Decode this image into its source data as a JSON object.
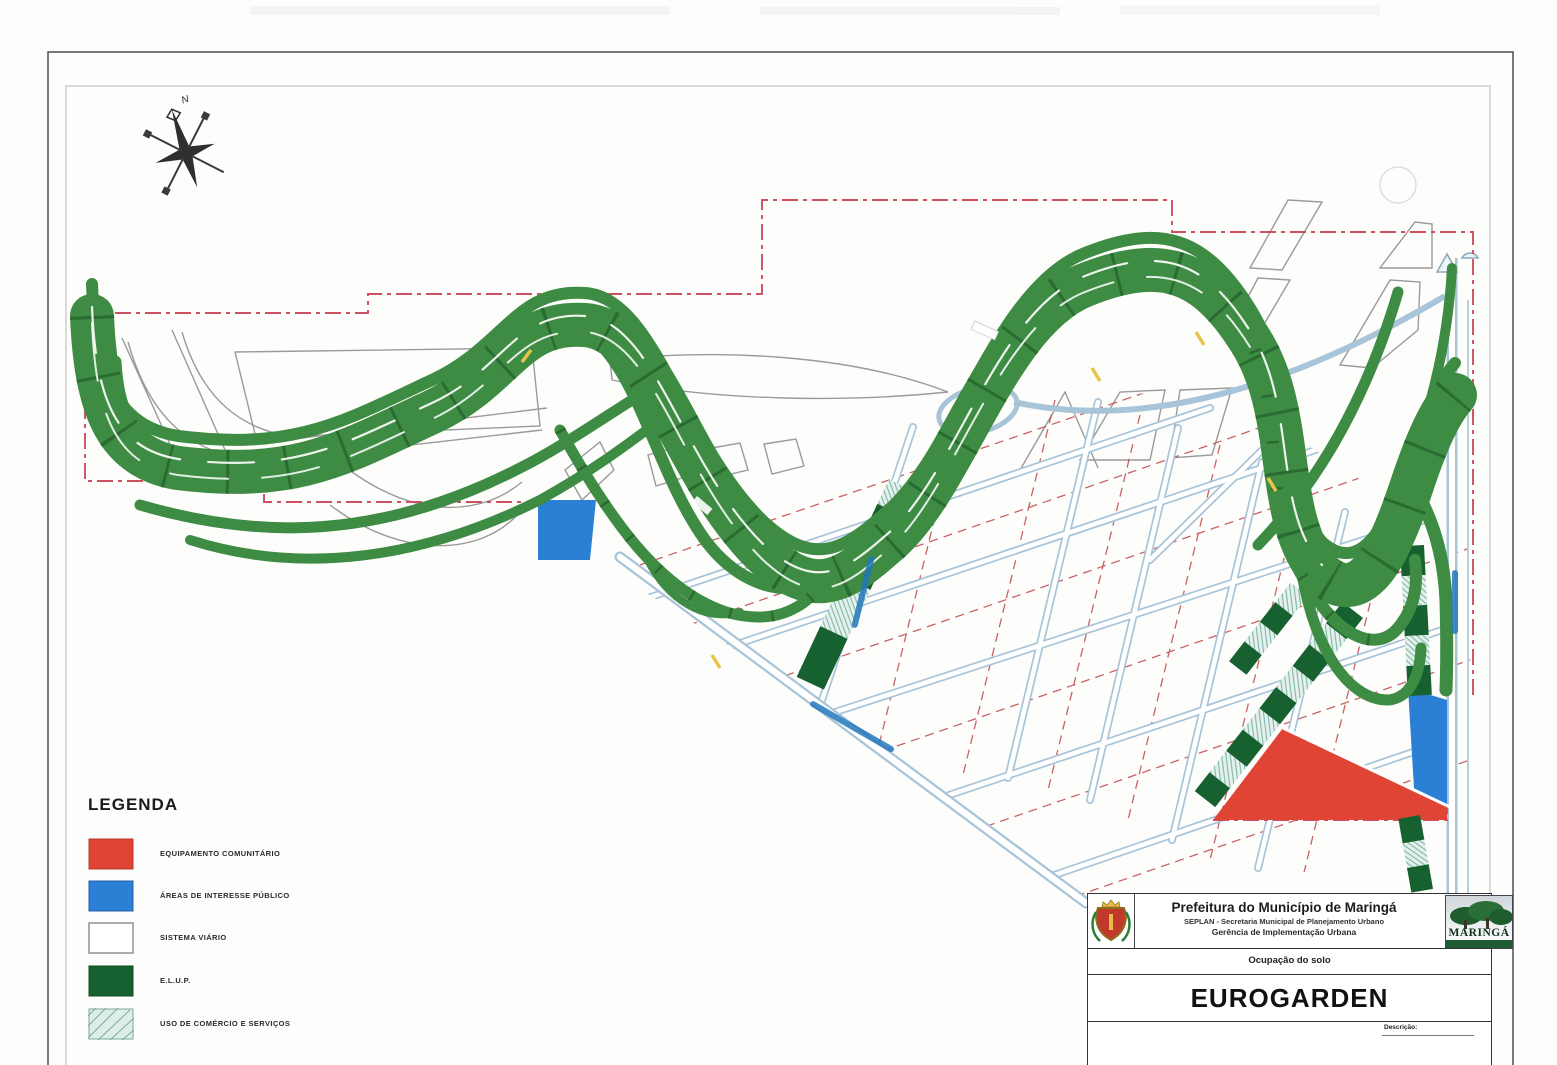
{
  "compass": {
    "north_label": "N"
  },
  "legend": {
    "title": "LEGENDA",
    "items": [
      {
        "label": "EQUIPAMENTO COMUNITÁRIO",
        "swatch": "#e04434",
        "style": "solid"
      },
      {
        "label": "ÁREAS DE INTERESSE PÚBLICO",
        "swatch": "#2b7fd4",
        "style": "solid"
      },
      {
        "label": "SISTEMA VIÁRIO",
        "swatch": "#ffffff",
        "style": "outline"
      },
      {
        "label": "E.L.U.P.",
        "swatch": "#176130",
        "style": "solid"
      },
      {
        "label": "USO DE COMÉRCIO E SERVIÇOS",
        "swatch": "#ddeee8",
        "style": "hatched"
      }
    ]
  },
  "title_block": {
    "org": "Prefeitura do Município de Maringá",
    "dept_line1": "SEPLAN - Secretaria Municipal de Planejamento Urbano",
    "dept_line2": "Gerência de Implementação Urbana",
    "subject": "Ocupação do solo",
    "project": "EUROGARDEN",
    "description_label": "Descrição:",
    "logo_text": "MARINGÁ"
  },
  "map_colors": {
    "road_band_green": "#3e8c43",
    "band_tick_green": "#2a6b31",
    "elup_green": "#176130",
    "commerce_hatch": "#ddeee8",
    "equipamento_red": "#e04434",
    "interesse_blue": "#2b7fd4",
    "boundary_dashed_red": "#cc5060",
    "lot_line_red": "#c04848",
    "street_casing_blue": "#a8c4d8",
    "street_label_blue": "#2277bb",
    "outline_gray": "#999999"
  }
}
